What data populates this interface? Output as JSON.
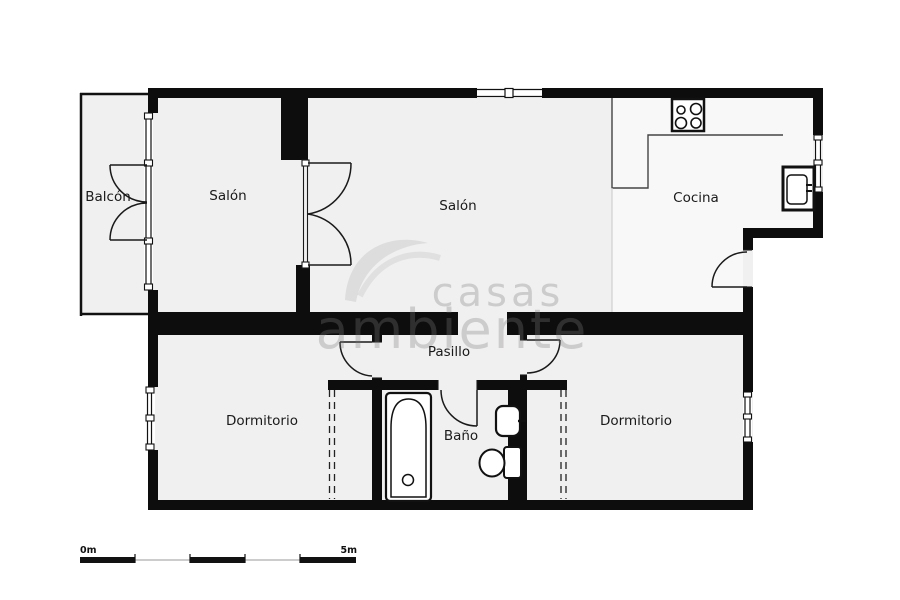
{
  "floorplan": {
    "rooms": {
      "balcon": {
        "label": "Balcón"
      },
      "salon_small": {
        "label": "Salón"
      },
      "salon_main": {
        "label": "Salón"
      },
      "cocina": {
        "label": "Cocina"
      },
      "pasillo": {
        "label": "Pasillo"
      },
      "dormitorio_left": {
        "label": "Dormitorio"
      },
      "bano": {
        "label": "Baño"
      },
      "dormitorio_right": {
        "label": "Dormitorio"
      }
    },
    "scale_bar": {
      "start_label": "0m",
      "end_label": "5m"
    },
    "watermark": {
      "line1": "casas",
      "line2": "ambiente"
    },
    "colors": {
      "wall": "#0d0d0d",
      "floor": "#f1f0f0",
      "floor_kitchen": "#f8f8f8",
      "label_text": "#1a1a1a",
      "watermark_gray": "#7d7d7d"
    }
  }
}
